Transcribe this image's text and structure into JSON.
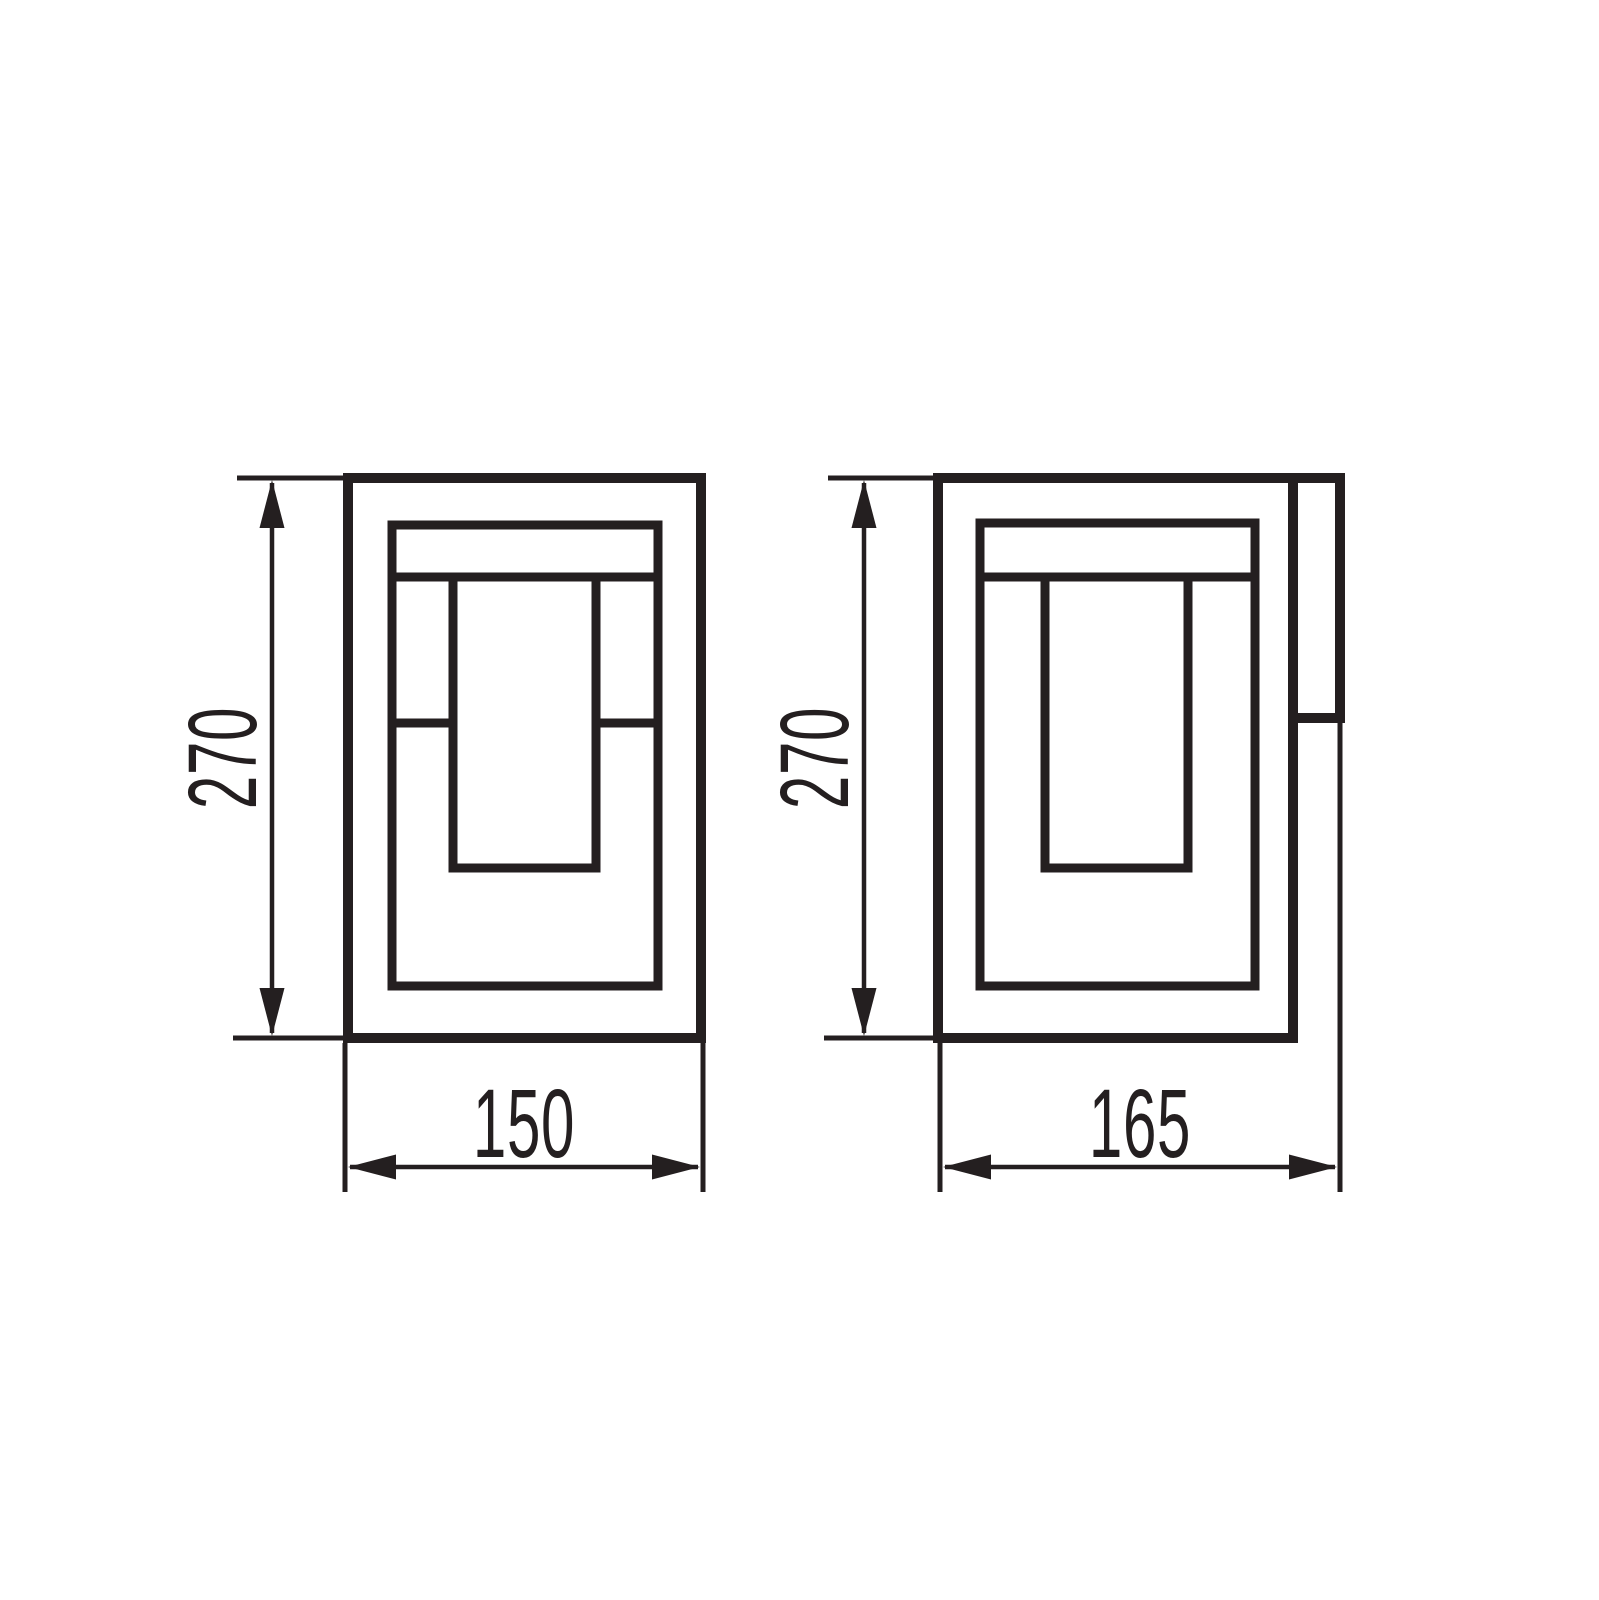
{
  "page": {
    "background_color": "#ffffff",
    "line_color": "#241f20",
    "type": "technical-dimension-drawing"
  },
  "views": {
    "front": {
      "height_label": "270",
      "width_label": "150"
    },
    "side": {
      "height_label": "270",
      "depth_label": "165"
    }
  }
}
